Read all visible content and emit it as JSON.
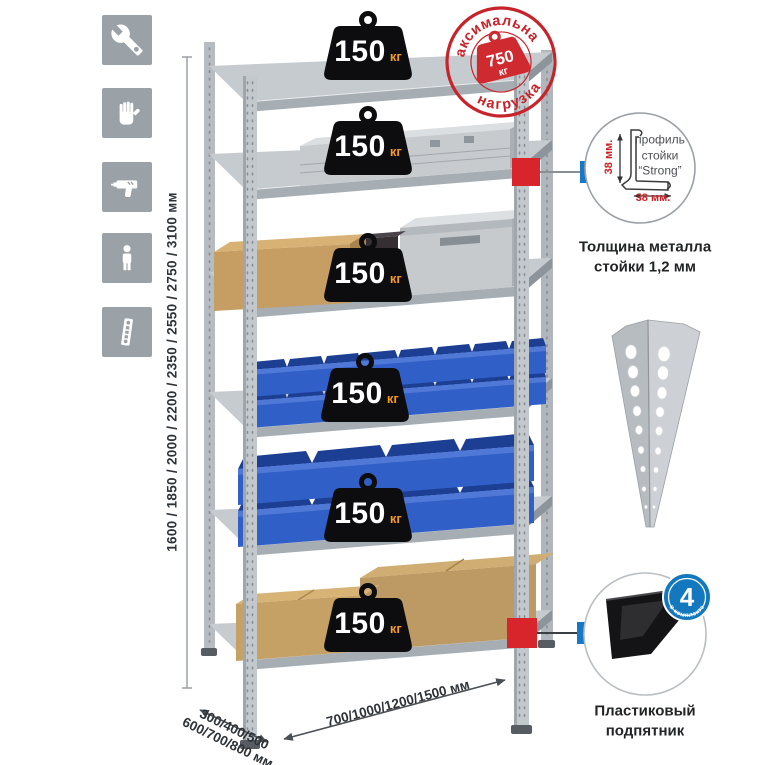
{
  "icons": {
    "list": [
      {
        "name": "wrench"
      },
      {
        "name": "gloves"
      },
      {
        "name": "drill"
      },
      {
        "name": "person"
      },
      {
        "name": "upright-strip"
      }
    ]
  },
  "rack": {
    "shelf_count": 6,
    "shelf_badge": {
      "value": "150",
      "unit": "кг"
    }
  },
  "max_load_stamp": {
    "arc_top": "максимальная",
    "arc_bottom": "нагрузка",
    "value": "750",
    "unit": "кг"
  },
  "dimensions": {
    "height": "1600 / 1850 / 2000 / 2200 / 2350 / 2550 / 2750 / 3100 мм",
    "depth_line1": "300/400/500",
    "depth_line2": "600/700/800 мм",
    "width": "700/1000/1200/1500 мм"
  },
  "profile_panel": {
    "dim_vertical": "38 мм.",
    "dim_horizontal": "38 мм.",
    "line1": "профиль",
    "line2": "стойки",
    "line3": "“Strong”",
    "caption1": "Толщина металла",
    "caption2": "стойки 1,2 мм"
  },
  "foot_panel": {
    "badge_number": "4",
    "badge_caption": "в комплекте",
    "caption1": "Пластиковый",
    "caption2": "подпятник"
  },
  "colors": {
    "stamp_red": "#c7232a",
    "connector_red": "#d8252c",
    "connector_blue": "#1878c8",
    "bin_blue": "#2f5fc7",
    "icon_gray": "#9aa1a7",
    "unit_orange": "#f39a1e"
  }
}
